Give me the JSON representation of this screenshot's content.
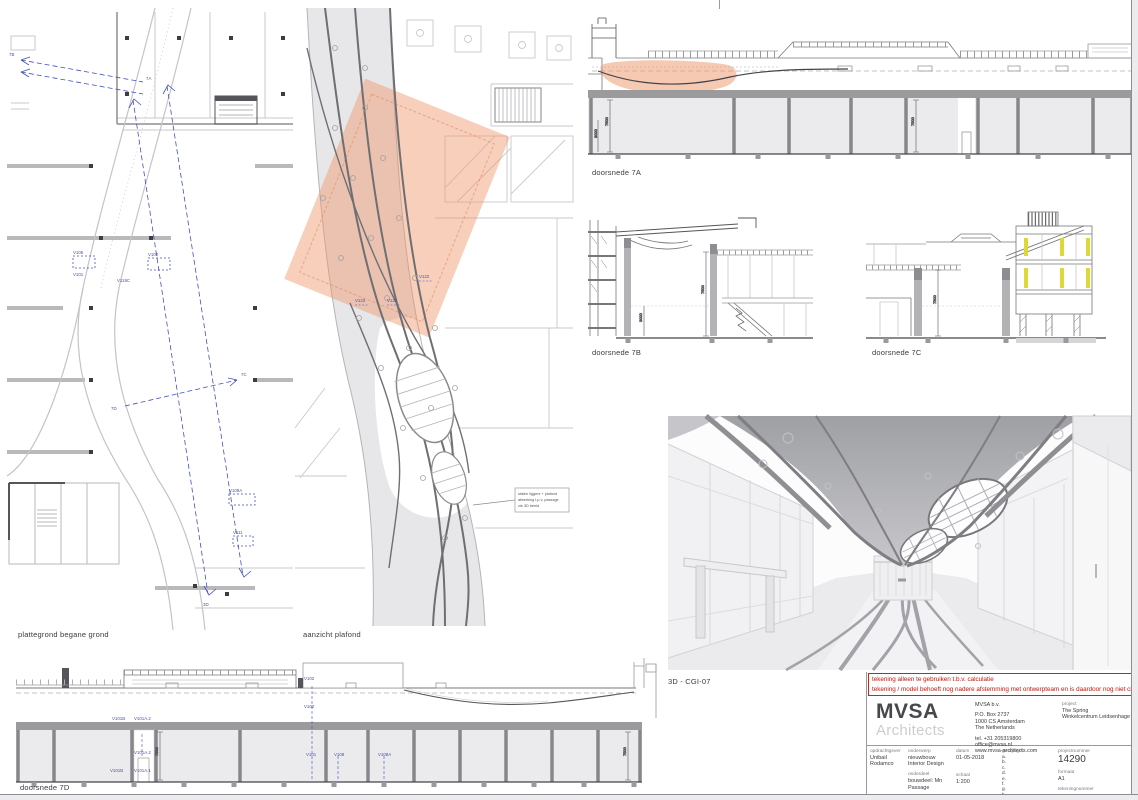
{
  "colors": {
    "highlight_orange": "#ee9468",
    "annotation_blue": "#4350c0",
    "warning_red": "#d81e12",
    "detail_yellow": "#ddd835"
  },
  "views": {
    "plan": {
      "label": "plattegrond begane grond",
      "tags": {
        "v105": "V105",
        "v101": "V101",
        "v102": "V102",
        "v119c": "V119C",
        "v109a": "V109A",
        "v111": "V111"
      },
      "markers": {
        "m7a": "7A",
        "m7b": "7B",
        "m7c": "7C",
        "m7d": "7D",
        "m3d": "3D"
      }
    },
    "ceiling": {
      "label": "aanzicht plafond",
      "tags": {
        "v122": "V122",
        "v123": "V123",
        "v124": "V124"
      },
      "note1": "stalen liggers + plafond",
      "note2": "afwerking t.p.v. passage",
      "note3": "zie 3D beeld"
    },
    "section_7a": {
      "label": "doorsnede 7A"
    },
    "section_7b": {
      "label": "doorsnede 7B"
    },
    "section_7c": {
      "label": "doorsnede 7C"
    },
    "section_7d": {
      "label": "doorsnede 7D",
      "tags": {
        "v101b": "V101B",
        "v101a1": "V101A.1",
        "v101a2": "V101A.2",
        "v102": "V102",
        "v101": "V101",
        "v108": "V108",
        "v108a": "V108A"
      }
    },
    "render_3d": {
      "label": "3D - CGI-07"
    },
    "dims": {
      "h7500": "7500",
      "h3000": "3000"
    }
  },
  "warning": {
    "line1": "tekening alleen te gebruiken t.b.v. calculatie",
    "line2": "tekening / model behoeft nog nadere afstemming met ontwerpteam en is daardoor nog niet clashvrij"
  },
  "titleblock": {
    "logo_line1": "MVSA",
    "logo_line2": "Architects",
    "company": {
      "name": "MVSA b.v.",
      "address1": "P.O. Box 2737",
      "address2": "1000 CS Amsterdam",
      "address3": "The Netherlands",
      "tel": "tel. +31 205319800",
      "email": "office@mvsa.nl",
      "web": "www.mvsa-architects.com"
    },
    "project": {
      "label": "project",
      "line1": "The Spring",
      "line2": "Winkelcentrum Leidsenhage"
    },
    "fields": {
      "opdrachtgever": {
        "label": "opdrachtgever",
        "value": "Unibail Rodamco"
      },
      "onderwerp": {
        "label": "onderwerp",
        "value1": "nieuwbouw",
        "value2": "Interior Design"
      },
      "onderdeel": {
        "label": "onderdeel",
        "value": "bouwdeel: Mn Passage"
      },
      "fase": {
        "label": "fase",
        "value": "Tender Interieur"
      },
      "datum": {
        "label": "datum",
        "value": "01-05-2018"
      },
      "schaal": {
        "label": "schaal",
        "value": "1:200"
      },
      "status": {
        "label": "status",
        "value": "StavaZa"
      },
      "gewijzigd": {
        "label": "gewijzigd",
        "items": [
          "a.",
          "b.",
          "c.",
          "d.",
          "e.",
          "f.",
          "g.",
          "h."
        ]
      },
      "projectnummer": {
        "label": "projectnummer",
        "value": "14290"
      },
      "formaat": {
        "label": "formaat",
        "value": "A1"
      },
      "tekeningnummer": {
        "label": "tekeningnummer",
        "value": "AD-I_CGI_07"
      }
    }
  }
}
